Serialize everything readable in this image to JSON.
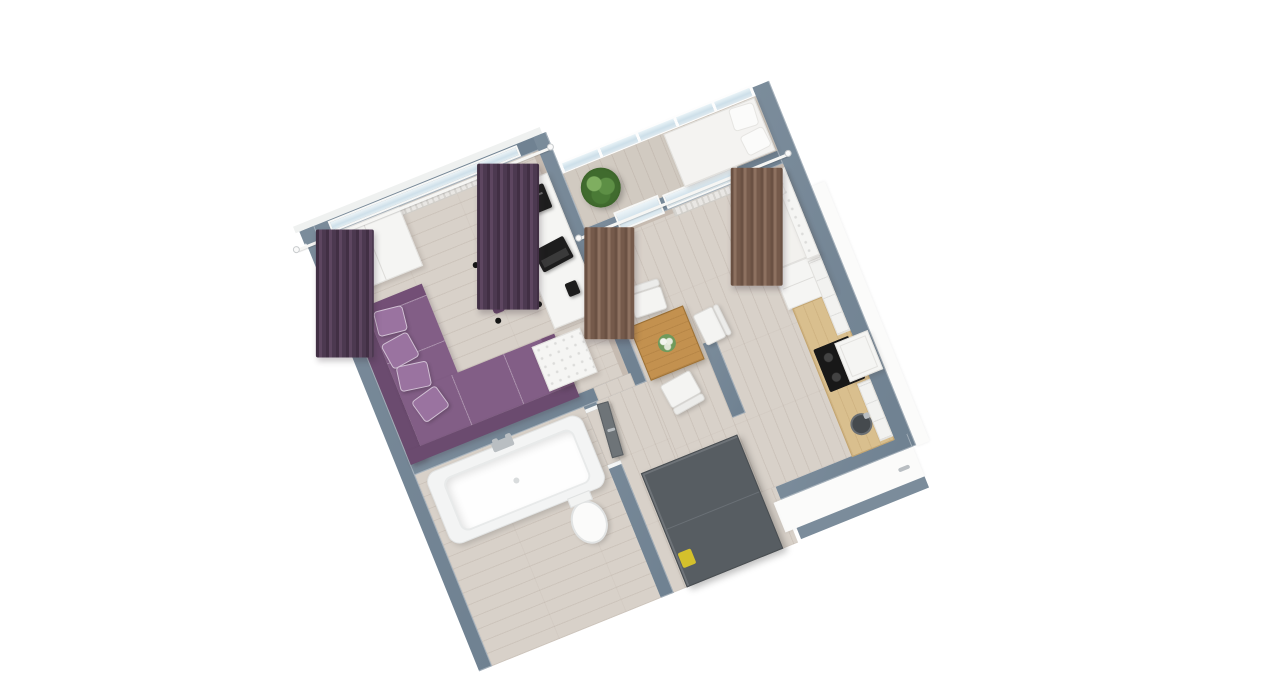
{
  "scene": {
    "name": "apartment-3d-floorplan-render",
    "view": "isometric-top-down",
    "rotation_deg": -22,
    "background": "#ffffff",
    "colors": {
      "wallTop": "#7b8c9b",
      "wallTop2": "#6f8191",
      "floorWood": "#d8d1c9",
      "loggiaFloor": "#d1cac1",
      "curtainPurpleDark": "#412f44",
      "curtainPurpleLight": "#5d4660",
      "curtainBrownDark": "#6a5143",
      "curtainBrownLight": "#8d7160",
      "sofaPurple": "#825e86",
      "sofaPurpleDark": "#6b4b6f",
      "sofaPillow": "#9a73a0",
      "chairPurple": "#7a5580",
      "chairPurpleDark": "#6a476d",
      "applianceWhite": "#f5f5f3",
      "tableWood": "#c3914f",
      "counterWood": "#d9bf8e",
      "cooktopBlack": "#181818",
      "doorGray": "#6e7478",
      "wardrobeDark": "#575d62",
      "glass": "#d7e7f0",
      "radiator": "#e9e7e4",
      "plantGreen": "#4f7f3c",
      "accentYellow": "#d4c02c",
      "electronics": "#1d1d1d",
      "innerFace": "#c6bbb1"
    },
    "rooms": [
      {
        "name": "living-room",
        "furniture": [
          "white-wardrobe",
          "window-with-radiator",
          "curtain-rod",
          "purple-curtains",
          "white-desk",
          "printer",
          "laptop",
          "phone",
          "purple-office-chair",
          "purple-corner-sofa",
          "sofa-pillows",
          "tufted-ottoman"
        ]
      },
      {
        "name": "bathroom",
        "furniture": [
          "bathtub",
          "faucet",
          "toilet"
        ]
      },
      {
        "name": "hallway",
        "furniture": [
          "gray-door",
          "dark-wardrobe",
          "yellow-box"
        ]
      },
      {
        "name": "kitchen-living-room",
        "furniture": [
          "brown-curtains",
          "balcony-door",
          "window-with-radiator",
          "dining-table",
          "flower-vase",
          "white-chairs",
          "white-sofa-bed",
          "wooden-ladder-rack",
          "fridge",
          "kitchen-counter",
          "cooktop",
          "range-hood",
          "sink",
          "upper-cabinets"
        ]
      },
      {
        "name": "loggia-balcony",
        "furniture": [
          "glass-railing",
          "green-plant",
          "white-daybed",
          "daybed-pillows"
        ]
      }
    ]
  }
}
